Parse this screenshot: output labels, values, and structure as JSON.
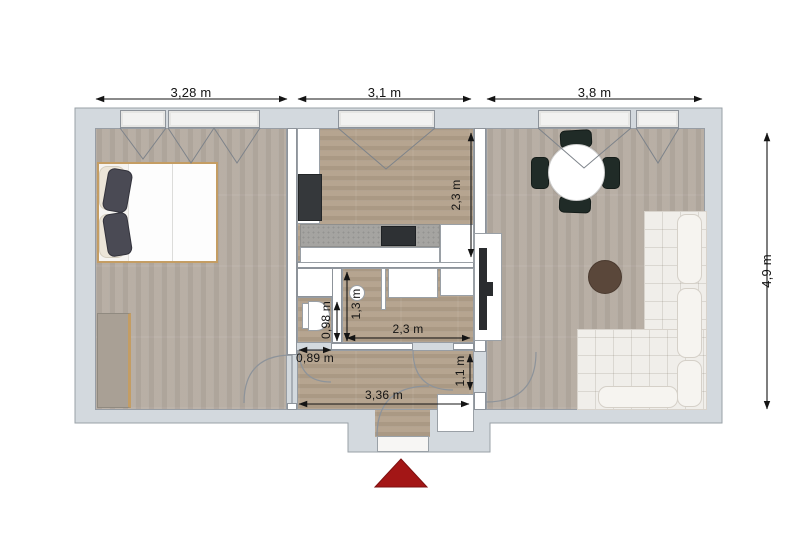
{
  "plan": {
    "dimensions": {
      "bedroom_width": "3,28 m",
      "kitchen_width": "3,1 m",
      "living_width": "3,8 m",
      "total_depth": "4,9 m",
      "kitchen_depth": "2,3 m",
      "bath_width": "2,3 m",
      "bath_depth": "1,3 m",
      "wc_depth": "0,98 m",
      "wc_door_width": "0,89 m",
      "living_door_width": "1,1 m",
      "hall_width": "3,36 m"
    },
    "colors": {
      "wall": "#d3d9de",
      "wall_outline": "#9aa1a7",
      "floor_cool": "#b6aca2",
      "floor_warm": "#b3a18b",
      "counter": "#a5a4a1",
      "appliance_dark": "#35383b",
      "chair_dark": "#202b27",
      "coffee_table_brown": "#5a473a",
      "sofa_white": "#f0eeea",
      "entrance_marker_red": "#a31616",
      "dimension_text": "#131313"
    },
    "furniture": [
      "double-bed",
      "wardrobe",
      "refrigerator",
      "kitchen-counter",
      "cooktop",
      "bath-sink",
      "toilet",
      "shower",
      "bath-cabinet",
      "tv",
      "dining-table",
      "dining-chairs",
      "corner-sofa",
      "coffee-table",
      "hall-cabinet"
    ],
    "markers": {
      "entrance_arrow": "triangle-up"
    }
  }
}
